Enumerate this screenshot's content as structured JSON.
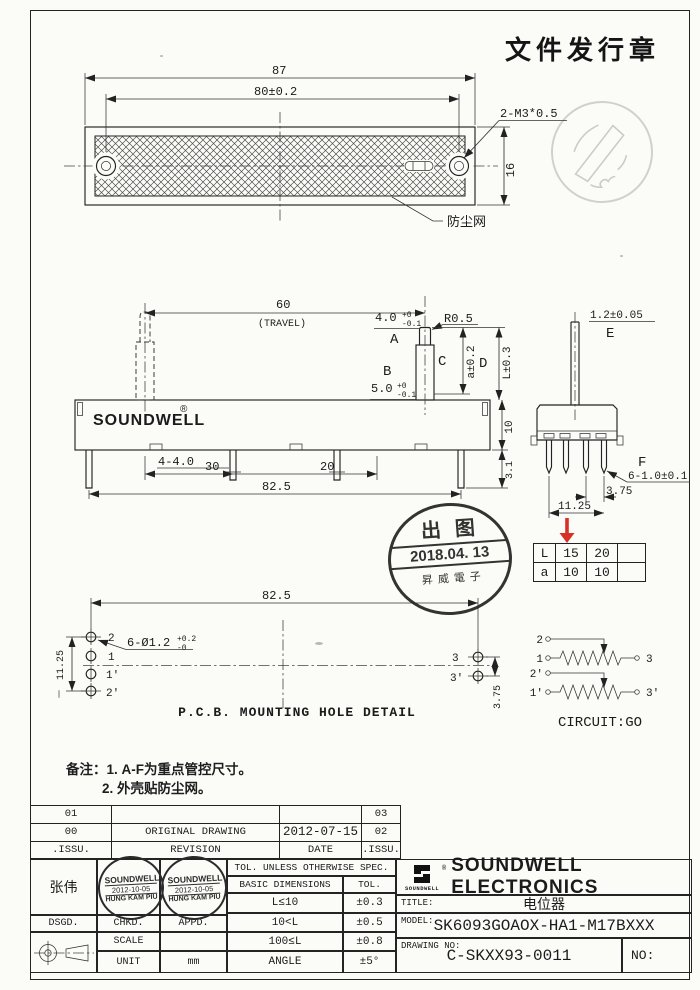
{
  "doc": {
    "issue_stamp": "文件发行章"
  },
  "top_view": {
    "dim_overall_width": "87",
    "dim_hole_pitch": "80±0.2",
    "screw_spec": "2-M3*0.5",
    "dim_height": "16",
    "dust_net": "防尘网"
  },
  "front_view": {
    "dim_travel": "60",
    "travel_note": "(TRAVEL)",
    "brand": "SOUNDWELL",
    "brand_reg": "®",
    "dim_a": "4.0",
    "dim_a_tol_up": "+0",
    "dim_a_tol_dn": "-0.1",
    "key_a": "A",
    "radius": "R0.5",
    "key_b": "B",
    "dim_b": "5.0",
    "dim_b_tol_up": "+0",
    "dim_b_tol_dn": "-0.1",
    "key_c": "C",
    "dim_c": "a±0.2",
    "key_d": "D",
    "dim_d": "L±0.3",
    "dim_lugs": "4-4.0",
    "dim_30": "30",
    "dim_20": "20",
    "dim_body_height": "10",
    "dim_pin_len": "3.1",
    "dim_base": "82.5"
  },
  "side_view": {
    "dim_lever": "1.2±0.05",
    "key_e": "E",
    "key_f": "F",
    "dim_pin_width": "6-1.0±0.1",
    "dim_pitch": "3.75",
    "dim_span": "11.25"
  },
  "variant_table": {
    "rows": [
      [
        "L",
        "15",
        "20",
        ""
      ],
      [
        "a",
        "10",
        "10",
        ""
      ]
    ]
  },
  "release_stamp": {
    "top": "出图",
    "date": "2018.04. 13",
    "bottom": "昇威電子"
  },
  "pcb": {
    "dim_span": "82.5",
    "hole_spec": "6-Ø1.2",
    "hole_tol_up": "+0.2",
    "hole_tol_dn": "-0",
    "dim_left_span": "11.25",
    "dim_right_pitch": "3.75",
    "labels": {
      "p2": "2",
      "p1": "1",
      "p1p": "1'",
      "p2p": "2'",
      "p3": "3",
      "p3p": "3'"
    },
    "caption": "P.C.B. MOUNTING HOLE DETAIL"
  },
  "circuit": {
    "caption": "CIRCUIT:GO",
    "t2": "2",
    "t1": "1",
    "t3": "3",
    "t2p": "2'",
    "t1p": "1'",
    "t3p": "3'"
  },
  "notes": {
    "label": "备注：",
    "line1": "1. A-F为重点管控尺寸。",
    "line2": "2. 外壳贴防尘网。"
  },
  "revision": {
    "r1": [
      "01",
      "",
      "",
      "03"
    ],
    "r2": [
      "00",
      "ORIGINAL  DRAWING",
      "2012-07-15",
      "02"
    ],
    "r3": [
      ".ISSU.",
      "REVISION",
      "DATE",
      ".ISSU."
    ]
  },
  "block": {
    "designer": "张伟",
    "stamp_co": "SOUNDWELL",
    "stamp_date": "2012-10-05",
    "stamp_name": "HUNG KAM PIU",
    "dsgd": "DSGD.",
    "chkd": "CHKD.",
    "appd": "APPD.",
    "scale_label": "SCALE",
    "scale_value": "",
    "unit_label": "UNIT",
    "unit_value": "mm",
    "tol_header": "TOL. UNLESS  OTHERWISE  SPEC.",
    "basic_header": "BASIC  DIMENSIONS",
    "tol_col": "TOL.",
    "tol_rows": [
      [
        "L≤10",
        "±0.3"
      ],
      [
        "10<L",
        "±0.5"
      ],
      [
        "100≤L",
        "±0.8"
      ],
      [
        "ANGLE",
        "±5°"
      ]
    ],
    "company": "SOUNDWELL ELECTRONICS",
    "logo_label": "SOUNDWELL",
    "logo_reg": "®",
    "title_label": "TITLE:",
    "title_value": "电位器",
    "model_label": "MODEL:",
    "model_value": "SK6093GOAOX-HA1-M17BXXX",
    "dwg_label": "DRAWING NO:",
    "dwg_value": "C-SKXX93-0011",
    "no_label": "NO:"
  },
  "colors": {
    "ink": "#222222",
    "red": "#d93025",
    "paper": "#fbfbf8"
  }
}
